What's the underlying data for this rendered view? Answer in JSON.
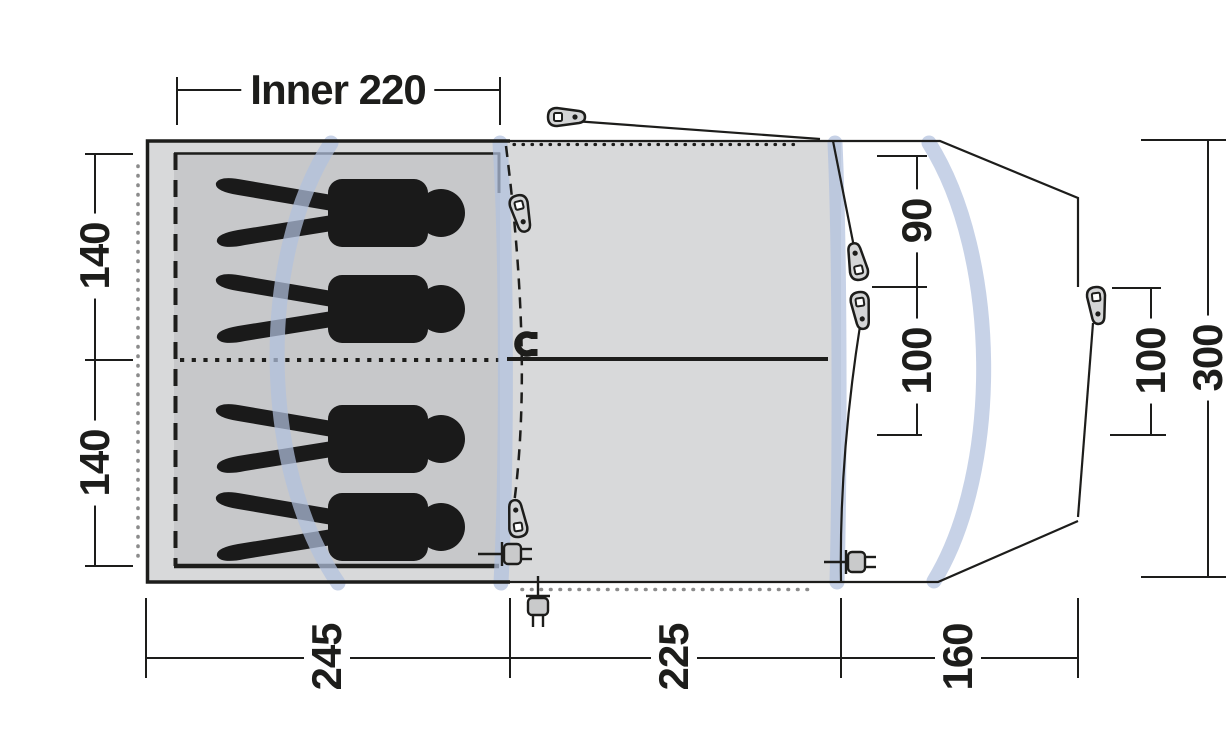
{
  "diagram": {
    "type": "tent-floorplan-top-view",
    "labels": {
      "inner_width": "Inner 220",
      "bedroom_depth_top": "140",
      "bedroom_depth_bottom": "140",
      "front_upper": "90",
      "front_lower": "100",
      "porch_door": "100",
      "total_depth": "300",
      "bedroom_length": "245",
      "living_length": "225",
      "porch_length": "160"
    },
    "colors": {
      "tent_fill": "#d8d9da",
      "inner_tent_fill": "#c7c8ca",
      "pole_blue": "#b2c1de",
      "outline": "#1d1d1b",
      "dot_gray": "#8b8b8b",
      "background": "#ffffff",
      "silhouette": "#1a1a1a"
    },
    "icons": {
      "zipper_pulls": 6,
      "power_plugs": 3,
      "magnet_closures": 1,
      "sleeping_persons": 4,
      "tent_poles": 4
    }
  }
}
